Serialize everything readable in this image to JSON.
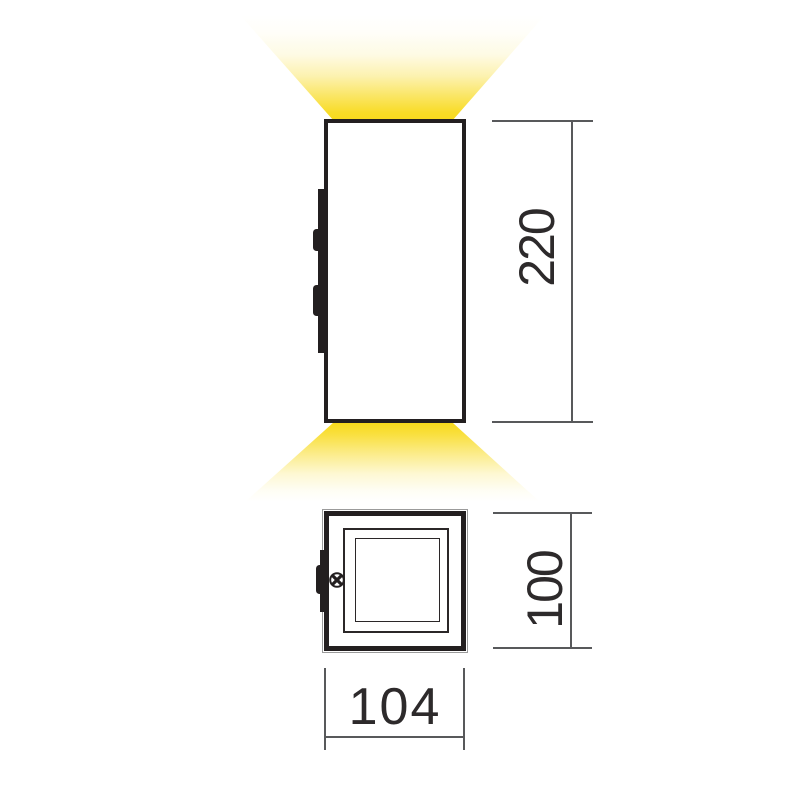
{
  "diagram": {
    "type": "luminaire-dimension-drawing",
    "views": {
      "front": "front-elevation-with-up-down-light-beams",
      "plan": "top-view-square-profile"
    },
    "dimensions": {
      "height": "220",
      "depth": "100",
      "width": "104"
    },
    "icons": {
      "screw": "phillips-screw-icon"
    },
    "colors": {
      "light_beam": "#F8DA1C",
      "outline": "#231F20",
      "dimension_line": "#58595B",
      "dimension_text": "#2D2A2B",
      "background": "#FFFFFF"
    }
  }
}
